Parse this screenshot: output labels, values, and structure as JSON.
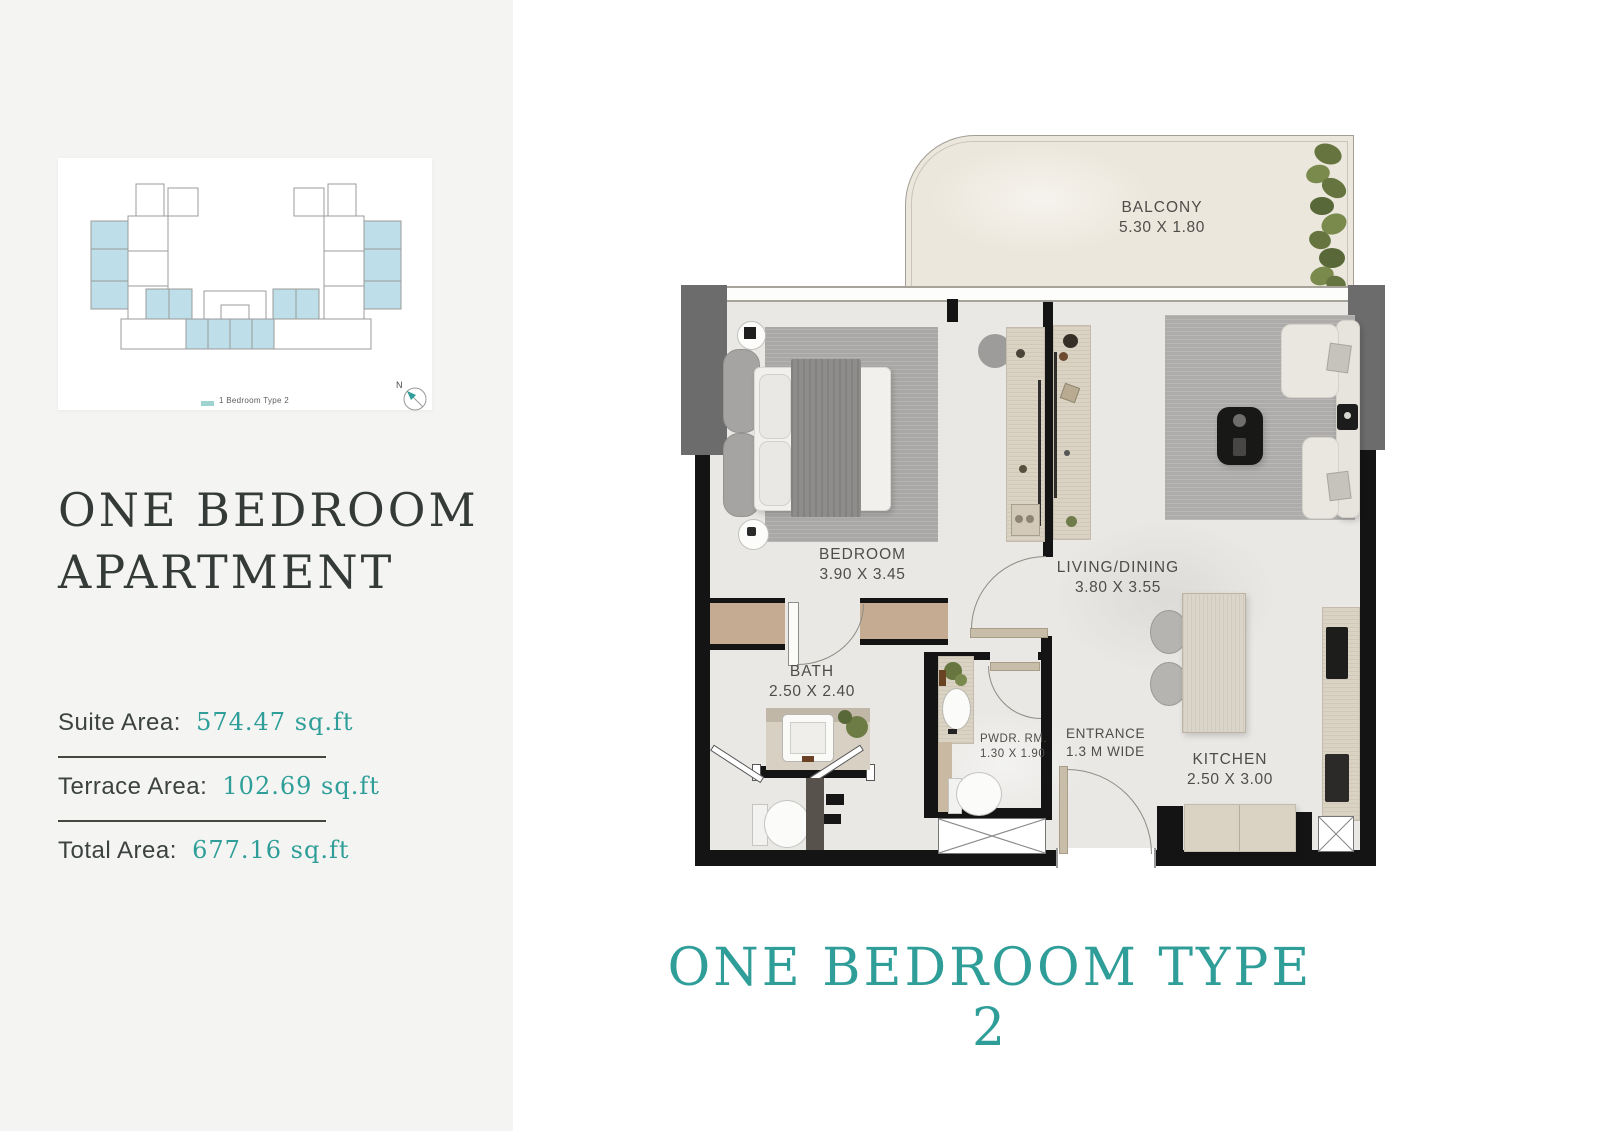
{
  "sidebar": {
    "key_plan": {
      "legend_label": "1 Bedroom Type 2",
      "compass_label": "N"
    },
    "title_line1": "ONE BEDROOM",
    "title_line2": "APARTMENT",
    "areas": [
      {
        "label": "Suite Area:",
        "value": "574.47 sq.ft"
      },
      {
        "label": "Terrace Area:",
        "value": "102.69 sq.ft"
      },
      {
        "label": "Total Area:",
        "value": "677.16 sq.ft"
      }
    ]
  },
  "plan": {
    "rooms": {
      "balcony": {
        "name": "BALCONY",
        "dims": "5.30 X 1.80"
      },
      "bedroom": {
        "name": "BEDROOM",
        "dims": "3.90 X 3.45"
      },
      "living": {
        "name": "LIVING/DINING",
        "dims": "3.80 X 3.55"
      },
      "bath": {
        "name": "BATH",
        "dims": "2.50 X 2.40"
      },
      "powder": {
        "name": "PWDR. RM.",
        "dims": "1.30 X 1.90"
      },
      "entrance": {
        "name": "ENTRANCE",
        "dims": "1.3 M WIDE"
      },
      "kitchen": {
        "name": "KITCHEN",
        "dims": "2.50 X 3.00"
      }
    },
    "footer_title": "ONE BEDROOM TYPE 2"
  },
  "colors": {
    "accent_teal": "#2f9e99",
    "keyplan_unit_blue": "#bedfe9",
    "wall": "#141414",
    "floor": "#e9e8e5",
    "balcony_floor": "#ece7dc"
  }
}
